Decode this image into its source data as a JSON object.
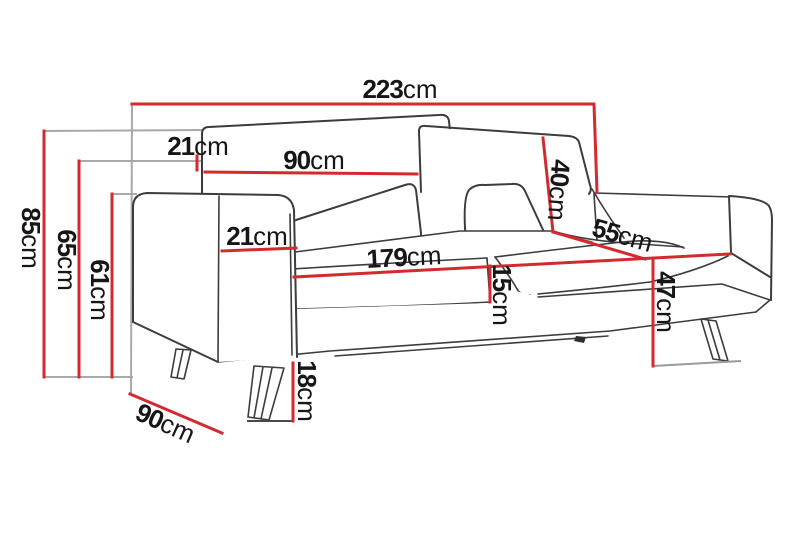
{
  "diagram": {
    "kind": "sofa-dimension-drawing",
    "unit": "cm"
  },
  "colors": {
    "dimension_line": "#d32a30",
    "extension_line": "#a9a9a9",
    "outline": "#3c3c3c",
    "label_ink": "#161616",
    "background": "#ffffff"
  },
  "dimensions": {
    "total_width": {
      "value": "223",
      "unit": "cm"
    },
    "total_height": {
      "value": "85",
      "unit": "cm"
    },
    "back_height": {
      "value": "65",
      "unit": "cm"
    },
    "arm_height": {
      "value": "61",
      "unit": "cm"
    },
    "backrest_top_depth": {
      "value": "21",
      "unit": "cm"
    },
    "back_cushion_width": {
      "value": "90",
      "unit": "cm"
    },
    "armrest_width": {
      "value": "21",
      "unit": "cm"
    },
    "seat_width": {
      "value": "179",
      "unit": "cm"
    },
    "back_cushion_height": {
      "value": "40",
      "unit": "cm"
    },
    "seat_depth": {
      "value": "55",
      "unit": "cm"
    },
    "cushion_thickness": {
      "value": "15",
      "unit": "cm"
    },
    "seat_height": {
      "value": "47",
      "unit": "cm"
    },
    "leg_height": {
      "value": "18",
      "unit": "cm"
    },
    "total_depth": {
      "value": "90",
      "unit": "cm"
    }
  }
}
